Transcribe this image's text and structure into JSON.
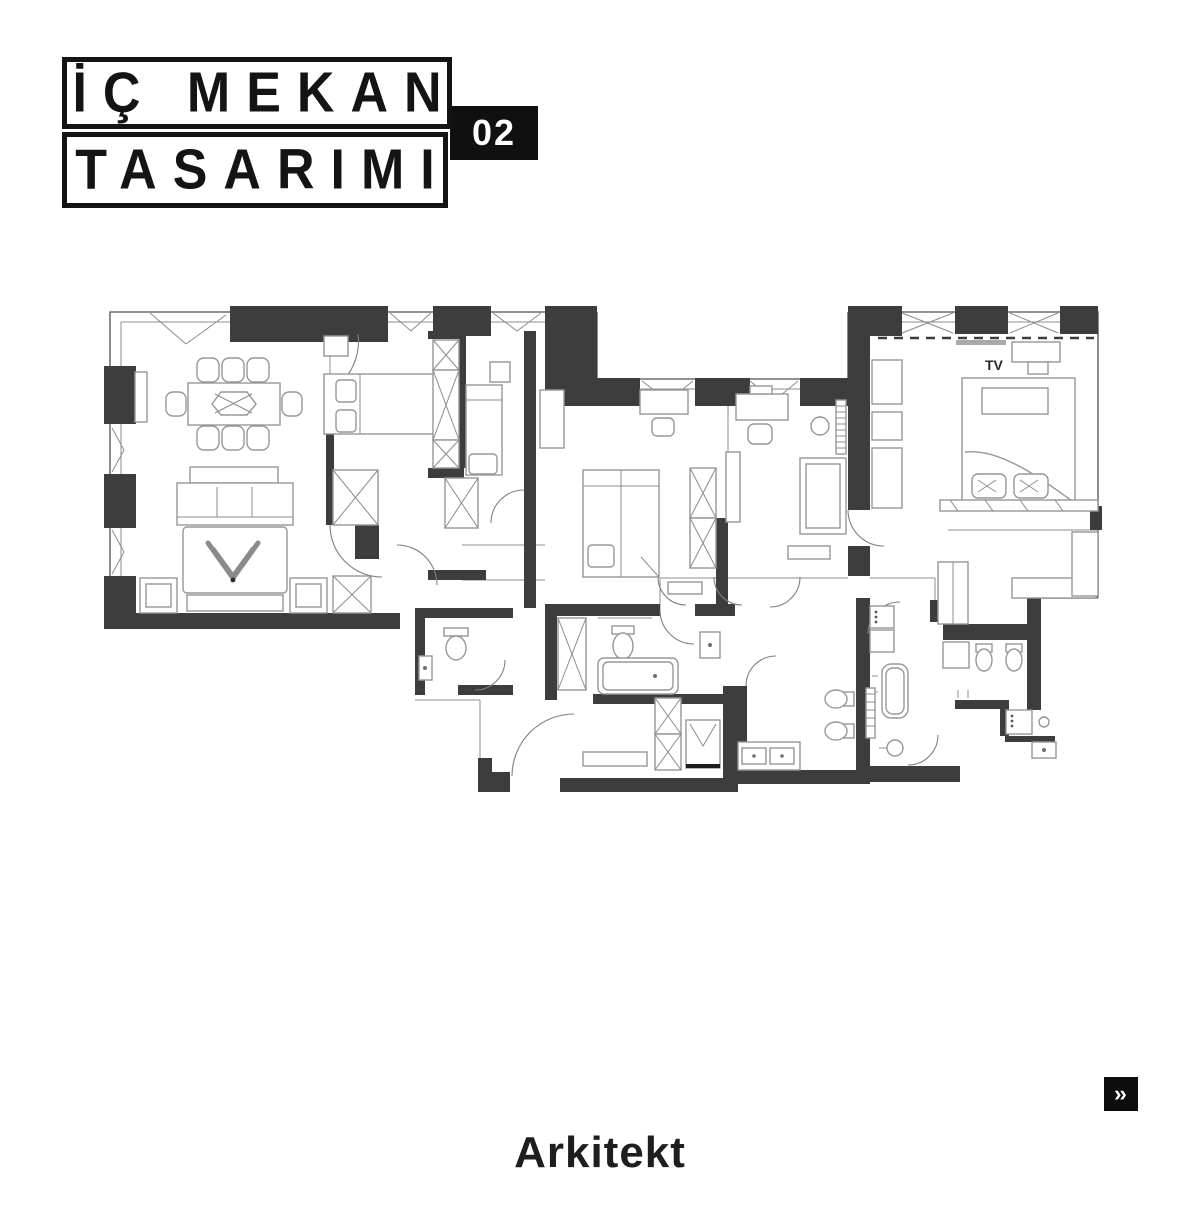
{
  "header": {
    "title_line1": "İÇ MEKAN",
    "title_line2": "TASARIMI",
    "badge": "02"
  },
  "plan": {
    "tv_label": "TV"
  },
  "footer": {
    "brand": "Arkitekt"
  },
  "nav": {
    "next_arrow": "››"
  },
  "colors": {
    "ink": "#141414",
    "wall": "#3d3d3d",
    "line": "#979797",
    "badge_bg": "#101010",
    "badge_text": "#ffffff",
    "background": "#ffffff"
  }
}
